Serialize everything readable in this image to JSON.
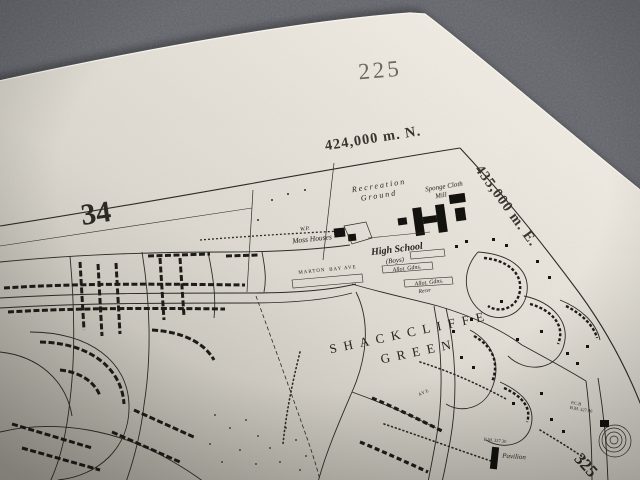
{
  "sheet": {
    "sheet_number": "225",
    "northing_label": "424,000 m. N.",
    "easting_label": "435,000 m. E.",
    "grid_figure_west": "34",
    "grid_figure_southeast": "325"
  },
  "labels": {
    "recreation_1": "Recreation",
    "recreation_2": "Ground",
    "mill_1": "Sponge Cloth",
    "mill_2": "Mill",
    "wp": "W.P.",
    "moss_houses": "Moss Houses",
    "high_school": "High School",
    "high_school_boys": "(Boys)",
    "marton": "MARTON",
    "bay_ave": "BAY AVE",
    "allot_gdns_1": "Allot. Gdns.",
    "allot_gdns_2": "Allot. Gdns.",
    "resvr": "Resvr",
    "shackcliffe": "SHACKCLIFFE",
    "green": "GREEN",
    "ave": "AVE",
    "pavilion": "Pavilion",
    "pcb": "P.C.B",
    "bm_327_90": "B.M. 327.90",
    "bm_327_30": "B.M. 327.30"
  },
  "colors": {
    "fabric": "#63646b",
    "paper_highlight": "#f4f1e8",
    "paper_mid": "#ddd9d0",
    "paper_shadow": "#c9c6bd",
    "ink": "#2e2b26",
    "sheet_number_ink": "#6e675c"
  }
}
